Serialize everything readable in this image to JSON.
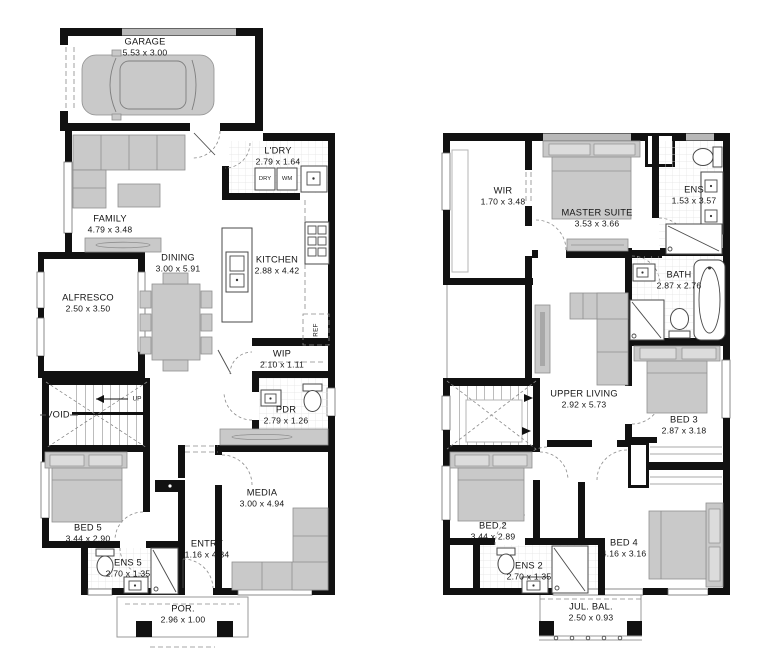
{
  "colors": {
    "wall": "#111111",
    "furniture": "#c9c9c9",
    "window_frame": "#6e6e6e",
    "tile_line": "#e3e3e3"
  },
  "ground_floor": {
    "rooms": [
      {
        "id": "garage",
        "name": "GARAGE",
        "dims": "5.53 x 3.00"
      },
      {
        "id": "ldry",
        "name": "L'DRY",
        "dims": "2.79 x 1.64"
      },
      {
        "id": "family",
        "name": "FAMILY",
        "dims": "4.79 x 3.48"
      },
      {
        "id": "dining",
        "name": "DINING",
        "dims": "3.00 x 5.91"
      },
      {
        "id": "kitchen",
        "name": "KITCHEN",
        "dims": "2.88 x 4.42"
      },
      {
        "id": "alfresco",
        "name": "ALFRESCO",
        "dims": "2.50 x 3.50"
      },
      {
        "id": "wip",
        "name": "WIP",
        "dims": "2.10 x 1.11"
      },
      {
        "id": "pdr",
        "name": "PDR",
        "dims": "2.79 x 1.26"
      },
      {
        "id": "void",
        "name": "VOID",
        "dims": ""
      },
      {
        "id": "bed5",
        "name": "BED 5",
        "dims": "3.44 x 2.90"
      },
      {
        "id": "media",
        "name": "MEDIA",
        "dims": "3.00 x 4.94"
      },
      {
        "id": "entry",
        "name": "ENTRY",
        "dims": "1.16 x 4.34"
      },
      {
        "id": "ens5",
        "name": "ENS 5",
        "dims": "2.70 x 1.35"
      },
      {
        "id": "por",
        "name": "POR.",
        "dims": "2.96 x 1.00"
      }
    ],
    "annotations": {
      "up": "UP",
      "dry": "DRY",
      "wm": "WM",
      "ref": "REF"
    }
  },
  "upper_floor": {
    "rooms": [
      {
        "id": "wir",
        "name": "WIR",
        "dims": "1.70 x 3.48"
      },
      {
        "id": "master",
        "name": "MASTER SUITE",
        "dims": "3.53 x 3.66"
      },
      {
        "id": "ens",
        "name": "ENS",
        "dims": "1.53 x 3.57"
      },
      {
        "id": "bath",
        "name": "BATH",
        "dims": "2.87 x 2.76"
      },
      {
        "id": "living",
        "name": "UPPER LIVING",
        "dims": "2.92 x 5.73"
      },
      {
        "id": "bed3",
        "name": "BED 3",
        "dims": "2.87 x 3.18"
      },
      {
        "id": "bed2",
        "name": "BED 2",
        "dims": "3.44 x 2.89"
      },
      {
        "id": "ens2",
        "name": "ENS 2",
        "dims": "2.70 x 1.35"
      },
      {
        "id": "bed4",
        "name": "BED 4",
        "dims": "4.16 x 3.16"
      },
      {
        "id": "julbal",
        "name": "JUL. BAL.",
        "dims": "2.50 x 0.93"
      }
    ]
  }
}
